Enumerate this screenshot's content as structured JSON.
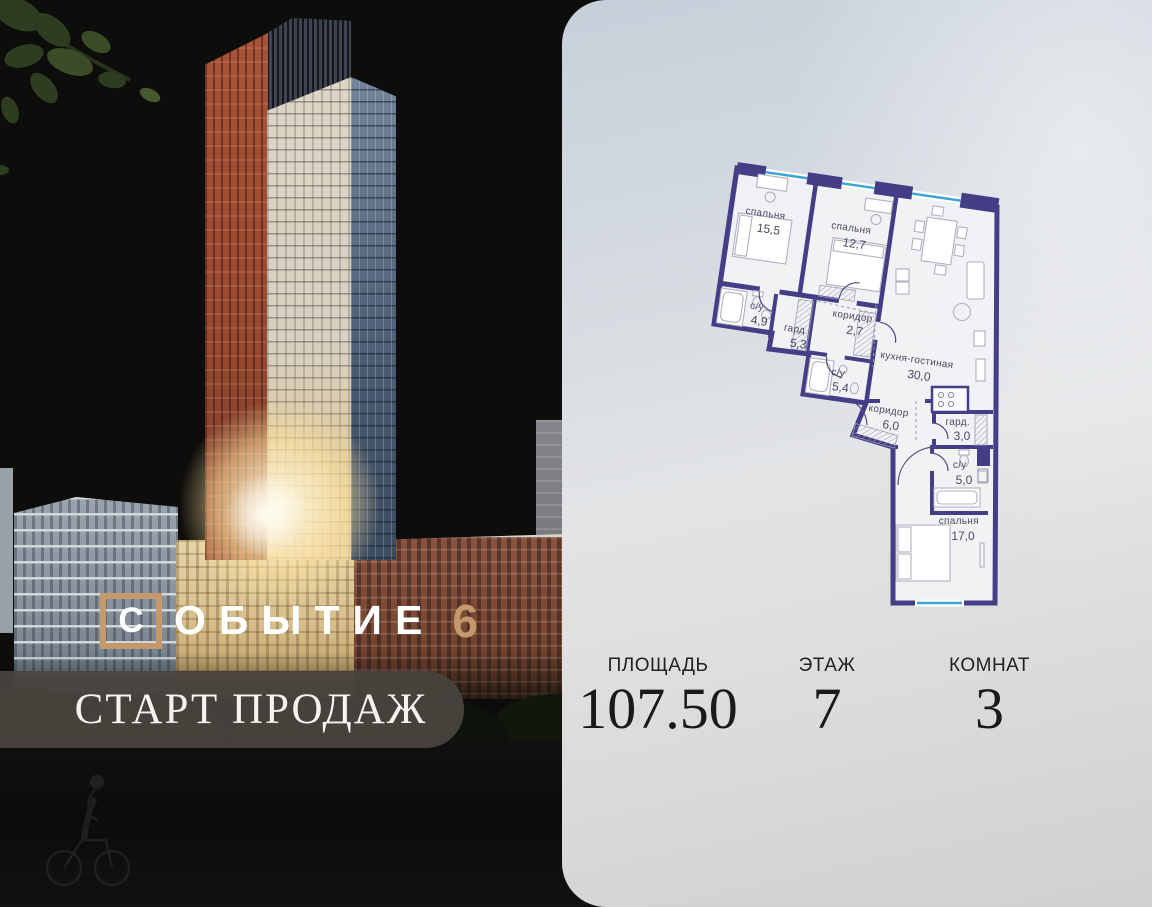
{
  "brand": {
    "boxed_letter": "С",
    "wordmark_letters": "ОБЫТИЕ",
    "number": "6",
    "accent_color": "#c49a6c",
    "banner_text": "СТАРТ ПРОДАЖ",
    "banner_bg": "#49433e"
  },
  "stats": {
    "items": [
      {
        "label": "ПЛОЩАДЬ",
        "value": "107.50"
      },
      {
        "label": "ЭТАЖ",
        "value": "7"
      },
      {
        "label": "КОМНАТ",
        "value": "3"
      }
    ]
  },
  "floor_plan": {
    "wall_color": "#433e85",
    "window_color": "#3fa3d6",
    "label_color": "#4a4a63",
    "rooms": [
      {
        "name": "спальня",
        "area": "15,5"
      },
      {
        "name": "спальня",
        "area": "12,7"
      },
      {
        "name": "с/у",
        "area": "4,9"
      },
      {
        "name": "гард.",
        "area": "5,3"
      },
      {
        "name": "коридор",
        "area": "2,7"
      },
      {
        "name": "с/у",
        "area": "5,4"
      },
      {
        "name": "кухня-гостиная",
        "area": "30,0"
      },
      {
        "name": "коридор",
        "area": "6,0"
      },
      {
        "name": "гард.",
        "area": "3,0"
      },
      {
        "name": "с/у",
        "area": "5,0"
      },
      {
        "name": "спальня",
        "area": "17,0"
      }
    ]
  }
}
